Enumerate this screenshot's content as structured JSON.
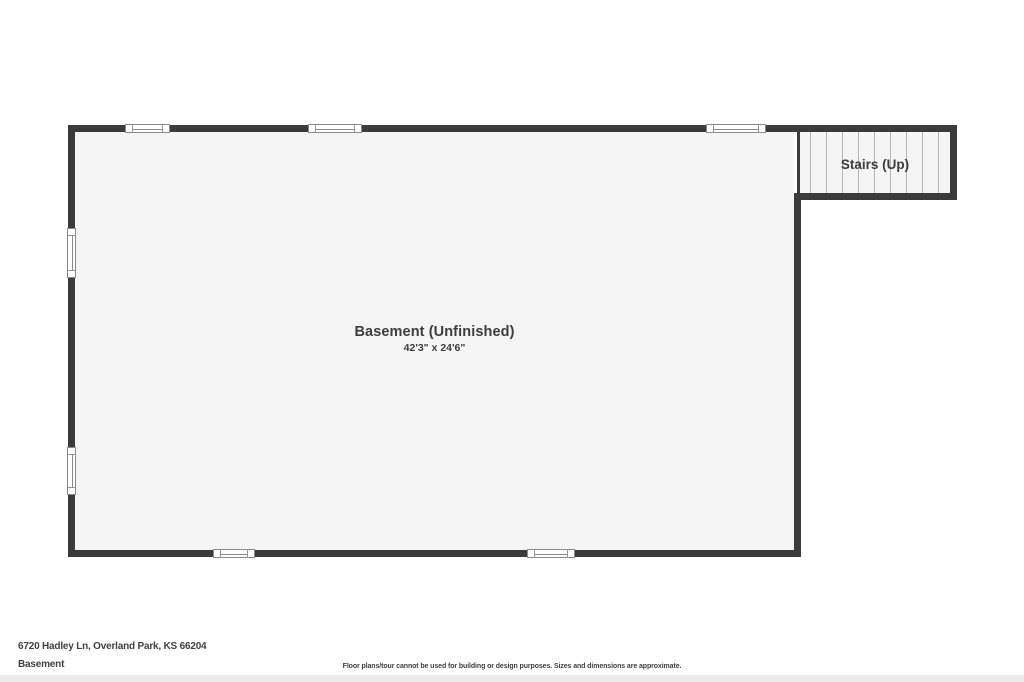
{
  "colors": {
    "wall": "#3b3b3b",
    "floor": "#f5f5f5",
    "window_frame": "#8a8a8a",
    "stair_tread_line": "#b5b5b5",
    "label_text": "#3d3d3d",
    "footer_bar": "#ececec",
    "background": "#ffffff"
  },
  "floorplan": {
    "rooms": [
      {
        "name": "Basement (Unfinished)",
        "dimensions": "42'3\" x 24'6\""
      }
    ],
    "stairs": {
      "label": "Stairs (Up)",
      "tread_count": 10
    },
    "window_count": 7
  },
  "footer": {
    "address": "6720 Hadley Ln, Overland Park, KS 66204",
    "floor_name": "Basement",
    "disclaimer": "Floor plans/tour cannot be used for building or design purposes. Sizes and dimensions are approximate."
  }
}
